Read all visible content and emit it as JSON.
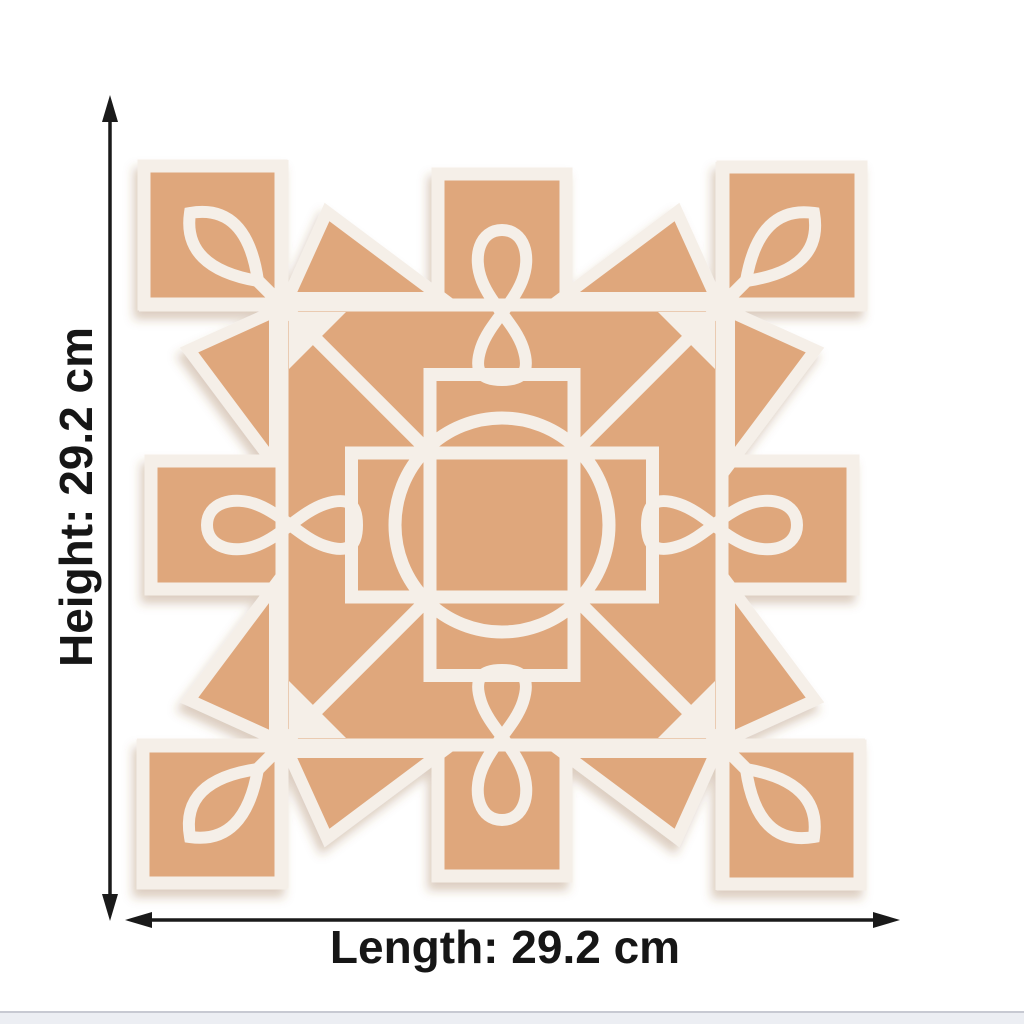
{
  "figure": {
    "subject": "white kolam rangoli stencil cut from MDF board, top view",
    "pattern_elements": [
      "border-squares",
      "corner-pinwheel-triangles",
      "leaf-motifs",
      "infinity-loops",
      "central-circle",
      "central-cross-rectangles"
    ],
    "board_color": "#dfa77c",
    "board_color_deep": "#d89e70",
    "stencil_color": "#f5efe8",
    "shadow_color": "#8a5a33"
  },
  "annotations": {
    "height_label": "Height: 29.2 cm",
    "length_label": "Length: 29.2 cm",
    "height_value": "29.2",
    "length_value": "29.2",
    "unit": "cm",
    "arrow_color": "#1a1a1a",
    "text_color": "#161616"
  },
  "backdrop": {
    "background": "#ffffff",
    "floor_strip_color": "#eceef3",
    "floor_line_color": "#c7c9d2"
  }
}
